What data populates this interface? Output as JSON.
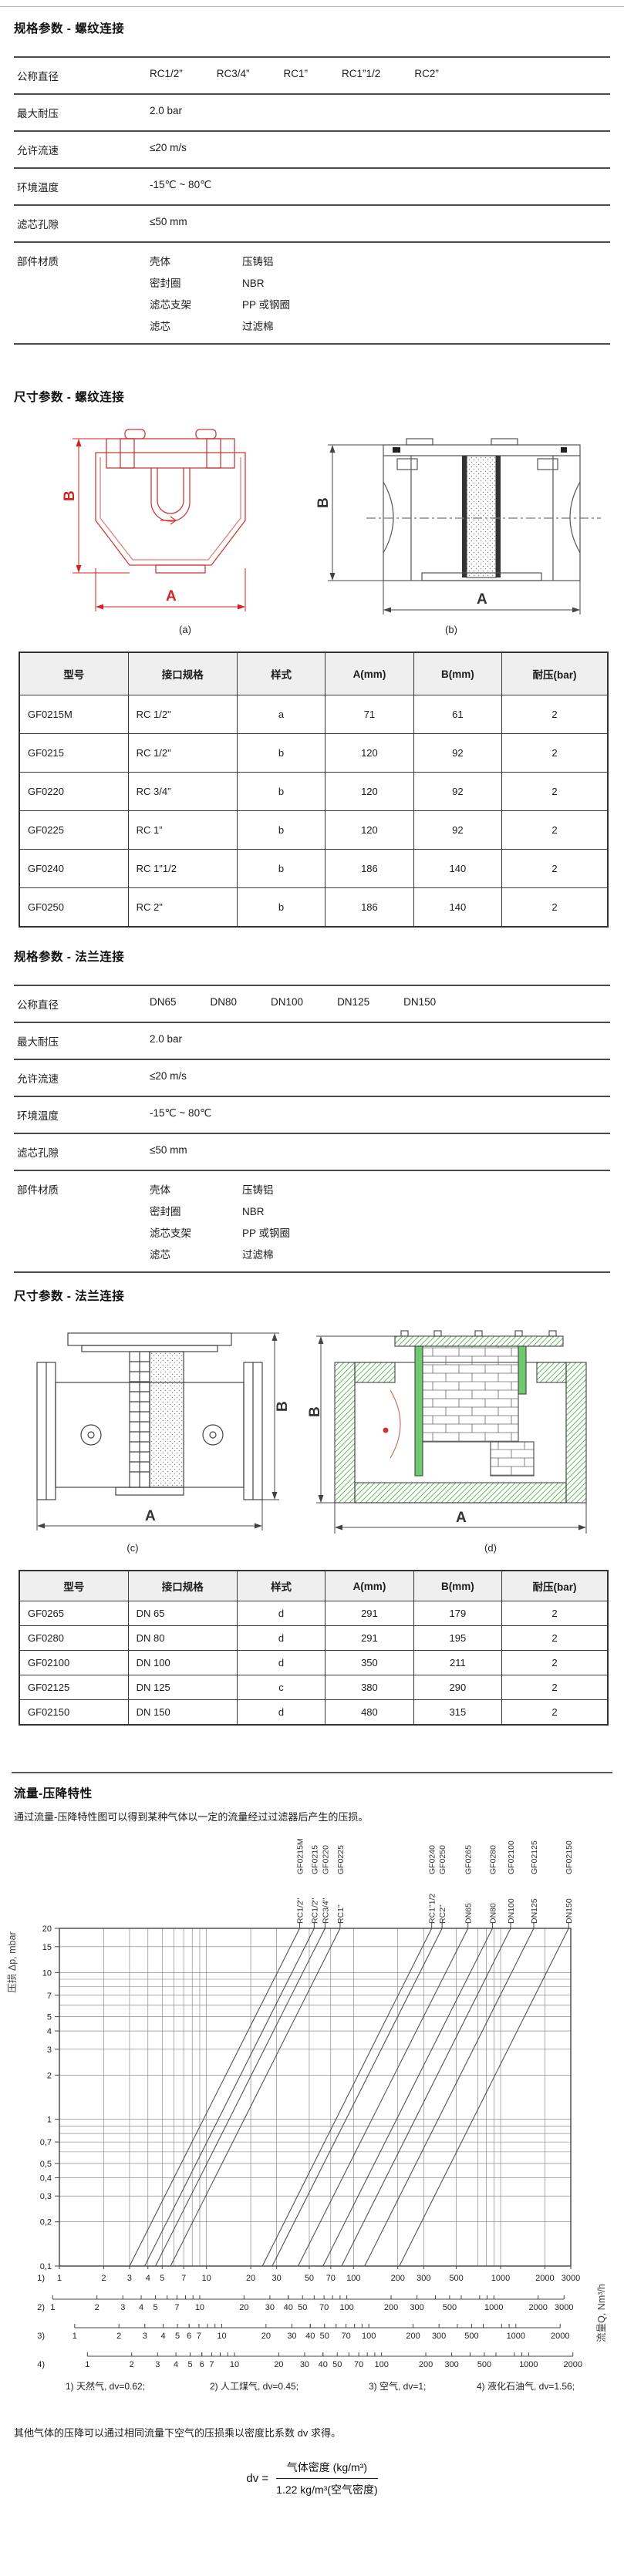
{
  "sections": {
    "spec_thread": {
      "title": "规格参数 - 螺纹连接",
      "rows": [
        {
          "label": "公称直径",
          "values": [
            "RC1/2”",
            "RC3/4”",
            "RC1”",
            "RC1”1/2",
            "RC2”"
          ]
        },
        {
          "label": "最大耐压",
          "values": [
            "2.0 bar"
          ]
        },
        {
          "label": "允许流速",
          "values": [
            "≤20 m/s"
          ]
        },
        {
          "label": "环境温度",
          "values": [
            "-15℃ ~ 80℃"
          ]
        },
        {
          "label": "滤芯孔隙",
          "values": [
            "≤50 mm"
          ]
        },
        {
          "label": "部件材质",
          "pairs": [
            [
              "壳体",
              "压铸铝"
            ],
            [
              "密封圈",
              "NBR"
            ],
            [
              "滤芯支架",
              "PP 或钢圈"
            ],
            [
              "滤芯",
              "过滤棉"
            ]
          ]
        }
      ]
    },
    "dim_thread": {
      "title": "尺寸参数 - 螺纹连接",
      "fig_labels": [
        "(a)",
        "(b)"
      ],
      "table": {
        "headers": [
          "型号",
          "接口规格",
          "样式",
          "A(mm)",
          "B(mm)",
          "耐压(bar)"
        ],
        "rows": [
          [
            "GF0215M",
            "RC 1/2\"",
            "a",
            "71",
            "61",
            "2"
          ],
          [
            "GF0215",
            "RC 1/2\"",
            "b",
            "120",
            "92",
            "2"
          ],
          [
            "GF0220",
            "RC 3/4”",
            "b",
            "120",
            "92",
            "2"
          ],
          [
            "GF0225",
            "RC 1”",
            "b",
            "120",
            "92",
            "2"
          ],
          [
            "GF0240",
            "RC 1\"1/2",
            "b",
            "186",
            "140",
            "2"
          ],
          [
            "GF0250",
            "RC 2\"",
            "b",
            "186",
            "140",
            "2"
          ]
        ]
      }
    },
    "spec_flange": {
      "title": "规格参数 - 法兰连接",
      "rows": [
        {
          "label": "公称直径",
          "values": [
            "DN65",
            "DN80",
            "DN100",
            "DN125",
            "DN150"
          ]
        },
        {
          "label": "最大耐压",
          "values": [
            "2.0 bar"
          ]
        },
        {
          "label": "允许流速",
          "values": [
            "≤20 m/s"
          ]
        },
        {
          "label": "环境温度",
          "values": [
            "-15℃ ~ 80℃"
          ]
        },
        {
          "label": "滤芯孔隙",
          "values": [
            "≤50 mm"
          ]
        },
        {
          "label": "部件材质",
          "pairs": [
            [
              "壳体",
              "压铸铝"
            ],
            [
              "密封圈",
              "NBR"
            ],
            [
              "滤芯支架",
              "PP 或钢圈"
            ],
            [
              "滤芯",
              "过滤棉"
            ]
          ]
        }
      ]
    },
    "dim_flange": {
      "title": "尺寸参数 - 法兰连接",
      "fig_labels": [
        "(c)",
        "(d)"
      ],
      "table": {
        "headers": [
          "型号",
          "接口规格",
          "样式",
          "A(mm)",
          "B(mm)",
          "耐压(bar)"
        ],
        "rows": [
          [
            "GF0265",
            "DN 65",
            "d",
            "291",
            "179",
            "2"
          ],
          [
            "GF0280",
            "DN 80",
            "d",
            "291",
            "195",
            "2"
          ],
          [
            "GF02100",
            "DN 100",
            "d",
            "350",
            "211",
            "2"
          ],
          [
            "GF02125",
            "DN 125",
            "c",
            "380",
            "290",
            "2"
          ],
          [
            "GF02150",
            "DN 150",
            "d",
            "480",
            "315",
            "2"
          ]
        ]
      }
    }
  },
  "drawings": {
    "dim_width_label": "A",
    "dim_height_label": "B"
  },
  "flow_section": {
    "title": "流量-压降特性",
    "description": "通过流量-压降特性图可以得到某种气体以一定的流量经过过滤器后产生的压损。",
    "note": "其他气体的压降可以通过相同流量下空气的压损乘以密度比系数 dv 求得。",
    "formula": {
      "lhs": "dv =",
      "numerator": "气体密度 (kg/m³)",
      "denominator": "1.22 kg/m³(空气密度)"
    }
  },
  "chart_data": {
    "type": "line",
    "title": "流量-压降特性",
    "x_label": "流量Q, Nm³/h",
    "y_label": "压损 Δp, mbar",
    "x_scale": "log",
    "y_scale": "log",
    "x_range": [
      1,
      3000
    ],
    "y_range": [
      0.1,
      20
    ],
    "grid": true,
    "y_tick_values": [
      20,
      15,
      10,
      7,
      5,
      4,
      3,
      2,
      1,
      0.7,
      0.5,
      0.4,
      0.3,
      0.2,
      0.1
    ],
    "y_tick_labels": [
      "20",
      "15",
      "10",
      "7",
      "5",
      "4",
      "3",
      "2",
      "1",
      "0,7",
      "0,5",
      "0,4",
      "0,3",
      "0,2",
      "0,1"
    ],
    "grid_x": [
      1,
      2,
      3,
      4,
      5,
      6,
      7,
      8,
      9,
      10,
      20,
      30,
      50,
      70,
      100,
      200,
      300,
      500,
      700,
      800,
      900,
      1000,
      2000,
      3000
    ],
    "grid_y": [
      0.1,
      0.2,
      0.3,
      0.4,
      0.5,
      0.6,
      0.7,
      0.8,
      0.9,
      1,
      2,
      3,
      4,
      5,
      6,
      7,
      8,
      9,
      10,
      15,
      20
    ],
    "series": [
      {
        "model": "GF0215M",
        "size": "RC1/2\"",
        "points": [
          [
            3.0,
            0.1
          ],
          [
            43,
            20
          ]
        ]
      },
      {
        "model": "GF0215",
        "size": "RC1/2\"",
        "points": [
          [
            3.8,
            0.1
          ],
          [
            54,
            20
          ]
        ]
      },
      {
        "model": "GF0220",
        "size": "RC3/4\"",
        "points": [
          [
            4.5,
            0.1
          ],
          [
            64,
            20
          ]
        ]
      },
      {
        "model": "GF0225",
        "size": "RC1\"",
        "points": [
          [
            5.7,
            0.1
          ],
          [
            81,
            20
          ]
        ]
      },
      {
        "model": "GF0240",
        "size": "RC1\"1/2",
        "points": [
          [
            24,
            0.1
          ],
          [
            340,
            20
          ]
        ]
      },
      {
        "model": "GF0250",
        "size": "RC2\"",
        "points": [
          [
            28,
            0.1
          ],
          [
            400,
            20
          ]
        ]
      },
      {
        "model": "GF0265",
        "size": "DN65",
        "points": [
          [
            42,
            0.1
          ],
          [
            600,
            20
          ]
        ]
      },
      {
        "model": "GF0280",
        "size": "DN80",
        "points": [
          [
            62,
            0.1
          ],
          [
            880,
            20
          ]
        ]
      },
      {
        "model": "GF02100",
        "size": "DN100",
        "points": [
          [
            83,
            0.1
          ],
          [
            1170,
            20
          ]
        ]
      },
      {
        "model": "GF02125",
        "size": "DN125",
        "points": [
          [
            119,
            0.1
          ],
          [
            1680,
            20
          ]
        ]
      },
      {
        "model": "GF02150",
        "size": "DN150",
        "points": [
          [
            205,
            0.1
          ],
          [
            2900,
            20
          ]
        ]
      }
    ],
    "gas_scales": [
      {
        "id": "1)",
        "gas": "天然气",
        "dv": 0.62,
        "factor": 1.0,
        "ticks": [
          1,
          2,
          3,
          4,
          5,
          7,
          10,
          20,
          30,
          50,
          70,
          100,
          200,
          300,
          500,
          1000,
          2000,
          3000
        ]
      },
      {
        "id": "2)",
        "gas": "人工煤气",
        "dv": 0.45,
        "factor": 0.9,
        "ticks": [
          1,
          2,
          3,
          4,
          5,
          7,
          10,
          20,
          30,
          40,
          50,
          70,
          100,
          200,
          300,
          500,
          1000,
          2000,
          3000
        ]
      },
      {
        "id": "3)",
        "gas": "空气",
        "dv": 1,
        "factor": 1.27,
        "ticks": [
          1,
          2,
          3,
          4,
          5,
          6,
          7,
          10,
          20,
          30,
          40,
          50,
          70,
          100,
          200,
          300,
          500,
          1000,
          2000
        ]
      },
      {
        "id": "4)",
        "gas": "液化石油气",
        "dv": 1.56,
        "factor": 1.55,
        "ticks": [
          1,
          2,
          3,
          4,
          5,
          6,
          7,
          10,
          20,
          30,
          40,
          50,
          70,
          100,
          200,
          300,
          500,
          1000,
          2000
        ]
      }
    ],
    "note_parts": [
      "1) 天然气, dv=0.62;",
      "2) 人工煤气, dv=0.45;",
      "3) 空气, dv=1;",
      "4) 液化石油气, dv=1.56;"
    ],
    "legend_position": "top-rotated-labels"
  }
}
